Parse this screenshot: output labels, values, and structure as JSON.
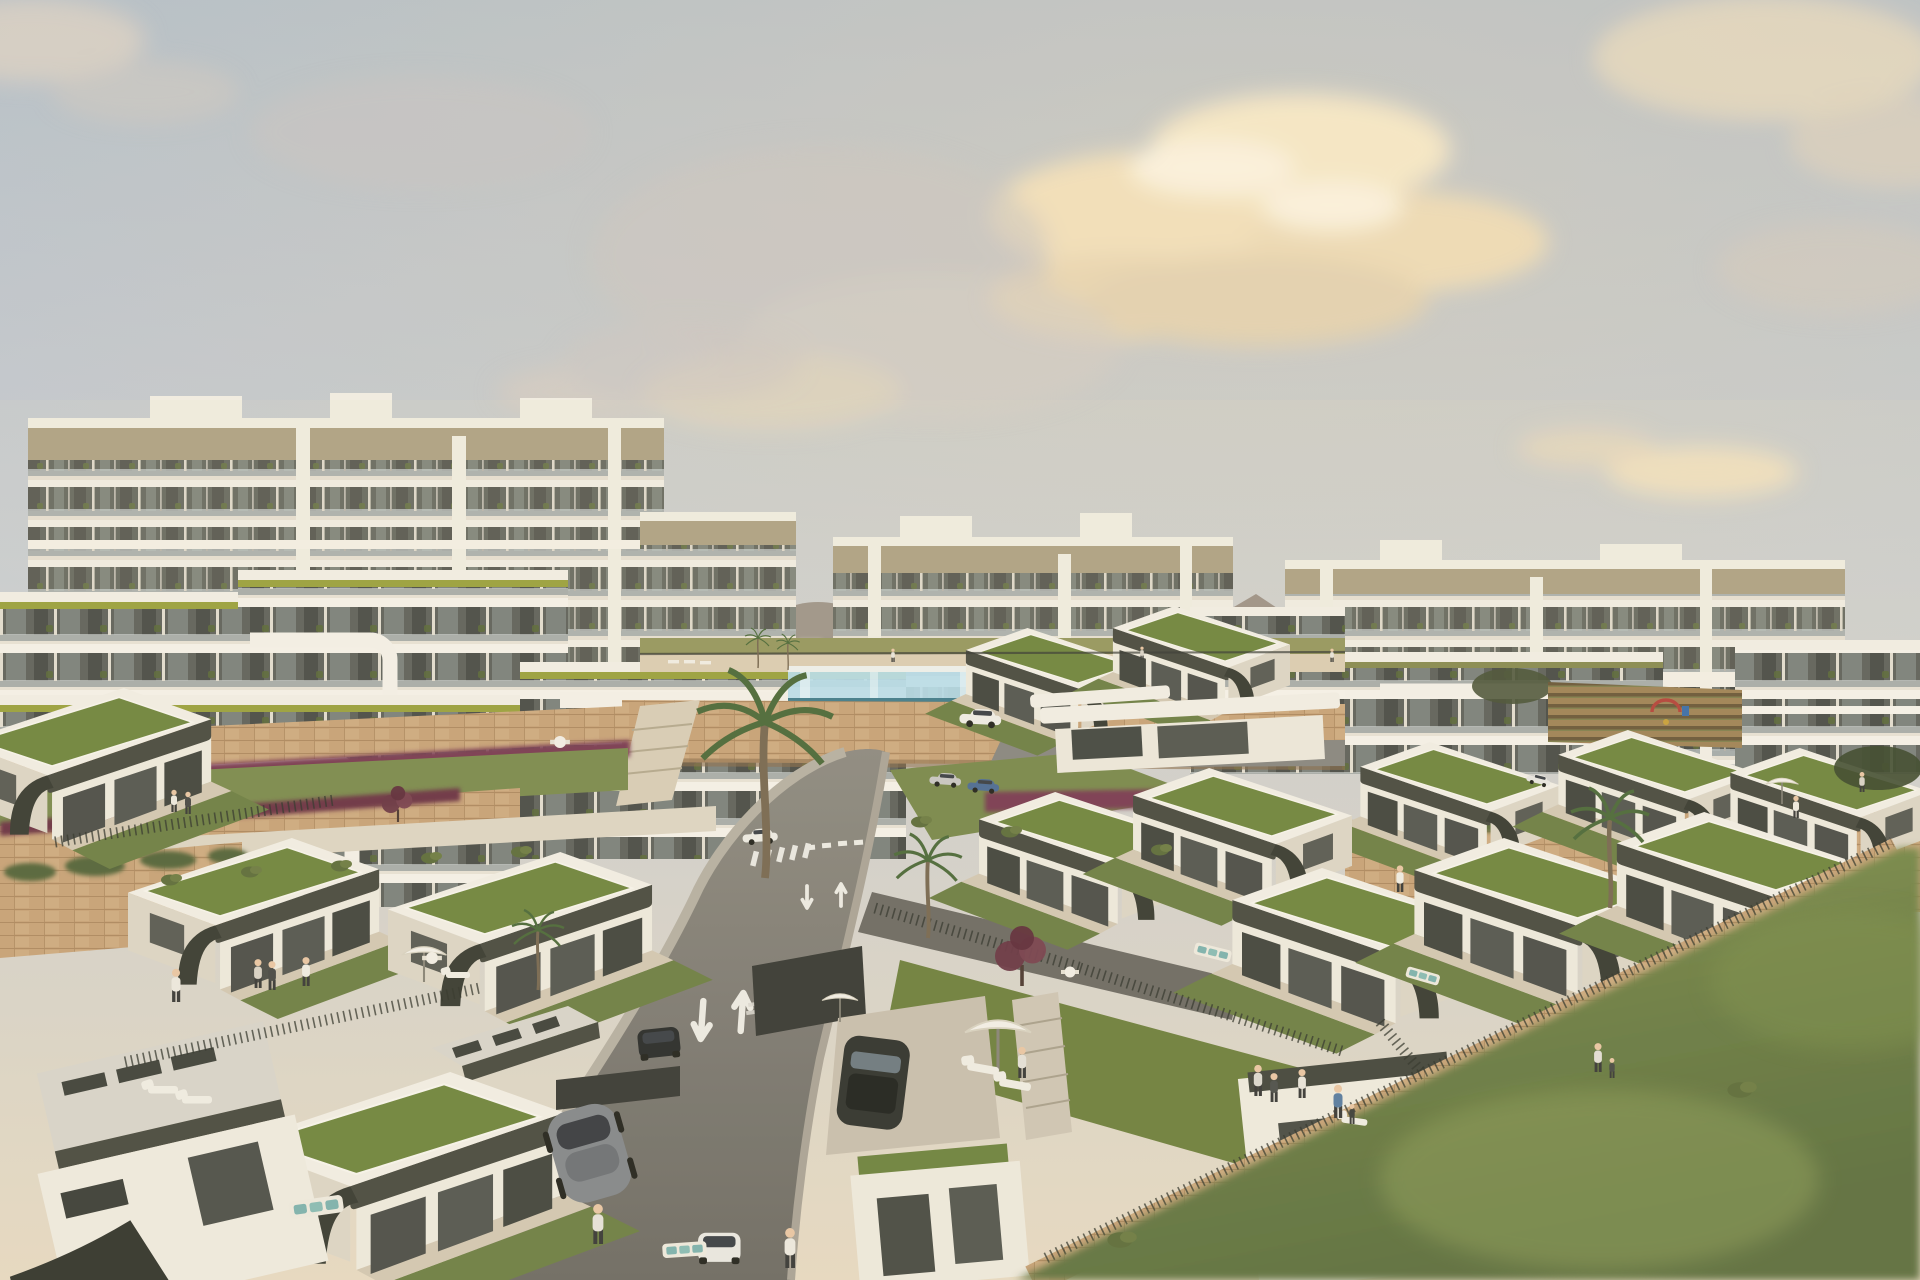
{
  "meta": {
    "description": "Aerial 3D architectural rendering of a coastal hillside residential development at golden hour: white apartment blocks with glass balconies in the background, terraced modern villas with green sedum roofs and dark olive fascias in the foreground, a glass-walled infinity pool, a curving access road with painted lane arrows, limestone retaining walls and a large blurred lawn in the lower right.",
    "time_of_day": "late afternoon",
    "style": "photoreal CGI render, shallow depth of field at image edges"
  },
  "palette": {
    "sky_top": "#b2becb",
    "sky_mid": "#c7ccd2",
    "sky_low": "#d8d3c9",
    "sky_horizon": "#e7dac1",
    "cloud_warm": "#f0dcb4",
    "cloud_bright": "#fbf1da",
    "cloud_gray": "#c8c0b6",
    "building_white": "#f2eee3",
    "building_shadow": "#d7d0c0",
    "fascia_tan": "#a89b7c",
    "stripe_lime": "#9ba23f",
    "glass_dark": "#5b5e56",
    "balcony_glass": "#c7cecd",
    "stone_wall": "#c8a378",
    "road_asphalt": "#7e7b74",
    "road_light": "#8f8b81",
    "road_marking": "#eceae2",
    "roof_green": "#71863f",
    "lawn_green": "#6f8045",
    "lawn_bright": "#8a9b55",
    "olive_fascia": "#4b4c41",
    "pool_glass": "#b9dde9",
    "pool_water": "#457e8c",
    "flower_magenta": "#7c3e52",
    "mountain": "#93867a",
    "mountain_far": "#897c6e",
    "concrete": "#c9bfad",
    "palm_green": "#4f6b3a",
    "vineyard_soil": "#a18457",
    "gravel_roof": "#d8d4ca",
    "skin": "#e9c7a4"
  },
  "scene": {
    "sky": {
      "coverage": "upper 42% of frame",
      "clouds": {
        "groups": 9,
        "tint": "warm peach with white cores"
      }
    },
    "mountains": {
      "ridges": 2,
      "position": "right horizon behind apartment blocks"
    },
    "apartments": {
      "back_row_blocks": 3,
      "mid_row_blocks": 7,
      "floors_typical": 6,
      "features": [
        "tan roof fascia",
        "white wraparound balcony bands",
        "glass balustrades",
        "balcony plants",
        "lime-green roof stripe on mid-row",
        "rooftop plant boxes"
      ]
    },
    "villas": {
      "count": 14,
      "roof": "flat green sedum roof with white parapet",
      "fascia": "dark olive curved band",
      "extras": [
        "gravel-roof garage volumes",
        "private lawns",
        "metal rail fences",
        "stone retaining walls"
      ]
    },
    "pool": {
      "type": "glass-walled infinity pool",
      "deck": "sun loungers and mini palms"
    },
    "road": {
      "shape": "curves downhill from the pool terrace to the bottom edge",
      "lane_arrows": [
        "down",
        "up"
      ],
      "arrow_sets": 3,
      "crosswalk": true,
      "give_way_dashes": true
    },
    "vehicles": [
      {
        "type": "hatchback",
        "color": "white",
        "location": "upper road"
      },
      {
        "type": "hatchback",
        "color": "white",
        "location": "mid road"
      },
      {
        "type": "hatchback",
        "color": "white",
        "location": "bottom road"
      },
      {
        "type": "sedan",
        "color": "silver",
        "location": "parked pair"
      },
      {
        "type": "sedan",
        "color": "blue",
        "location": "parked pair"
      },
      {
        "type": "suv",
        "color": "dark gray",
        "location": "villa driveway"
      },
      {
        "type": "sedan",
        "color": "black",
        "location": "street edge"
      },
      {
        "type": "sports car",
        "color": "gray",
        "location": "foreground driveway"
      }
    ],
    "people_count": 22,
    "palm_trees": 6,
    "burgundy_trees": 2,
    "furniture": [
      "sun loungers",
      "white parasols",
      "outdoor dining sets",
      "sofas with teal cushions"
    ],
    "playground": true,
    "vineyard_field": true,
    "lawn_bottom_right": {
      "blurred": true,
      "shape": "diagonal wedge"
    }
  }
}
